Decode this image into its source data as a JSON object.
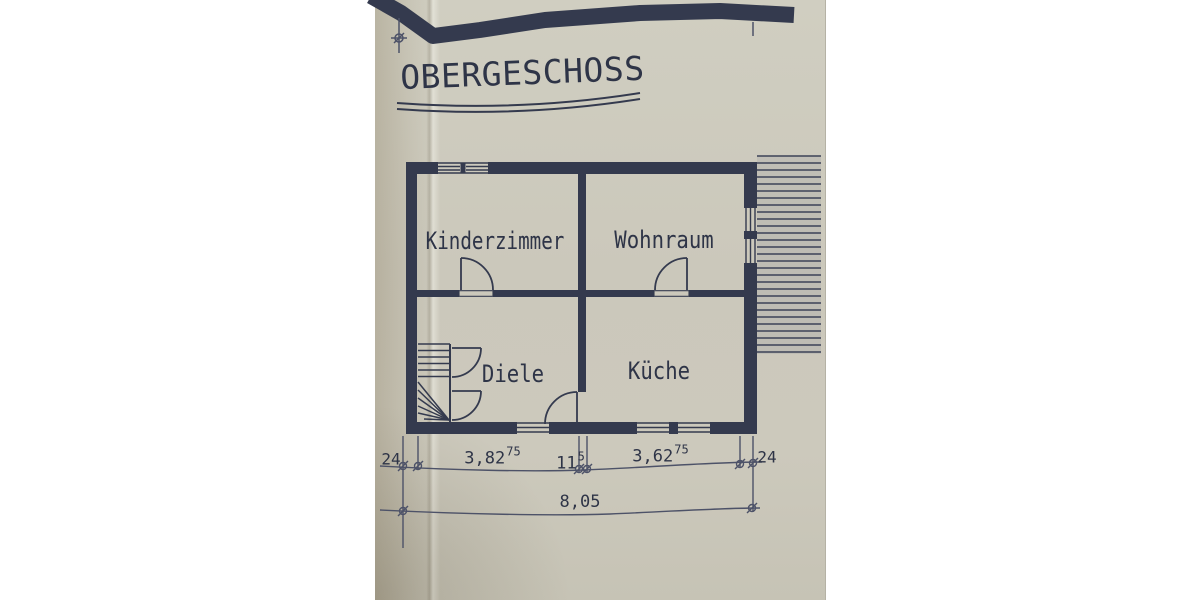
{
  "document": {
    "title": "OBERGESCHOSS",
    "floor_plan": {
      "rooms": [
        {
          "name": "Kinderzimmer"
        },
        {
          "name": "Wohnraum"
        },
        {
          "name": "Diele"
        },
        {
          "name": "Küche"
        }
      ]
    },
    "dimensions": {
      "wall_left": "24",
      "seg1_main": "3,82",
      "seg1_sup": "75",
      "seg2_main": "11",
      "seg2_sup": "5",
      "seg3_main": "3,62",
      "seg3_sup": "75",
      "wall_right": "24",
      "total": "8,05"
    },
    "colors": {
      "ink": "#343a4e",
      "thin_ink": "#4d5268",
      "paper": "#ccc9bc"
    }
  }
}
